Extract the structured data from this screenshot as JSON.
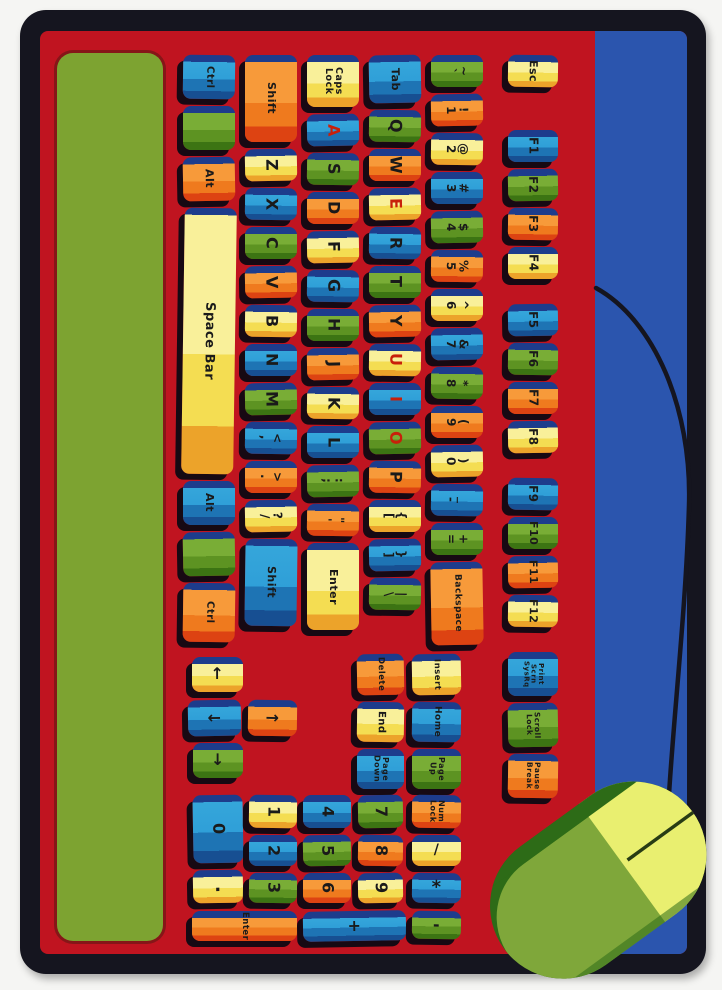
{
  "palette": {
    "border_black": "#15151f",
    "field_red": "#c01420",
    "stripe_green": "#7da331",
    "stripe_blue": "#2b55ae",
    "key_top_band_navy": "#1d3c8c",
    "key_blue": "#2f9fd8",
    "key_green": "#79ad36",
    "key_orange": "#ef7a1e",
    "key_yellow": "#f4dd52",
    "vowel_letter_red": "#c8200a",
    "mouse_dark_green": "#2d6b17",
    "mouse_light_green": "#7fa73a",
    "mouse_button_yellow": "#e9ef70",
    "cord_black": "#15151f"
  },
  "keyboard": {
    "columns": [
      {
        "x": 183,
        "w": 52,
        "y0": 55,
        "keys": [
          {
            "label": "Ctrl",
            "color": "blue",
            "u": 1.3
          },
          {
            "label": "",
            "color": "green",
            "u": 1.3
          },
          {
            "label": "Alt",
            "color": "orange",
            "u": 1.3
          },
          {
            "label": "Space Bar",
            "color": "yellow",
            "u": 7.0,
            "fs": 13
          },
          {
            "label": "Alt",
            "color": "blue",
            "u": 1.3
          },
          {
            "label": "",
            "color": "green",
            "u": 1.3
          },
          {
            "label": "Ctrl",
            "color": "orange",
            "u": 1.7
          }
        ]
      },
      {
        "x": 245,
        "w": 52,
        "y0": 55,
        "keys": [
          {
            "label": "Shift",
            "color": "orange",
            "u": 2.4,
            "fs": 11
          },
          {
            "label": "Z",
            "color": "yellow",
            "u": 1
          },
          {
            "label": "X",
            "color": "blue",
            "u": 1
          },
          {
            "label": "C",
            "color": "green",
            "u": 1
          },
          {
            "label": "V",
            "color": "orange",
            "u": 1
          },
          {
            "label": "B",
            "color": "yellow",
            "u": 1
          },
          {
            "label": "N",
            "color": "blue",
            "u": 1
          },
          {
            "label": "M",
            "color": "green",
            "u": 1
          },
          {
            "label": "<\n,",
            "color": "blue",
            "u": 1,
            "fs": 12
          },
          {
            "label": ">\n.",
            "color": "orange",
            "u": 1,
            "fs": 12
          },
          {
            "label": "?\n/",
            "color": "yellow",
            "u": 1,
            "fs": 12
          },
          {
            "label": "Shift",
            "color": "blue",
            "u": 2.4,
            "fs": 11
          }
        ]
      },
      {
        "x": 307,
        "w": 52,
        "y0": 55,
        "keys": [
          {
            "label": "Caps\nLock",
            "color": "yellow",
            "u": 1.5,
            "fs": 9.5
          },
          {
            "label": "A",
            "color": "blue",
            "u": 1,
            "red": true
          },
          {
            "label": "S",
            "color": "green",
            "u": 1
          },
          {
            "label": "D",
            "color": "orange",
            "u": 1
          },
          {
            "label": "F",
            "color": "yellow",
            "u": 1
          },
          {
            "label": "G",
            "color": "blue",
            "u": 1
          },
          {
            "label": "H",
            "color": "green",
            "u": 1
          },
          {
            "label": "J",
            "color": "orange",
            "u": 1
          },
          {
            "label": "K",
            "color": "yellow",
            "u": 1
          },
          {
            "label": "L",
            "color": "blue",
            "u": 1
          },
          {
            "label": ":\n;",
            "color": "green",
            "u": 1,
            "fs": 12
          },
          {
            "label": "\"\n'",
            "color": "orange",
            "u": 1,
            "fs": 12
          },
          {
            "label": "Enter",
            "color": "yellow",
            "u": 2.4,
            "fs": 11
          }
        ]
      },
      {
        "x": 369,
        "w": 52,
        "y0": 55,
        "keys": [
          {
            "label": "Tab",
            "color": "blue",
            "u": 1.4,
            "fs": 11
          },
          {
            "label": "Q",
            "color": "green",
            "u": 1
          },
          {
            "label": "W",
            "color": "orange",
            "u": 1
          },
          {
            "label": "E",
            "color": "yellow",
            "u": 1,
            "red": true
          },
          {
            "label": "R",
            "color": "blue",
            "u": 1
          },
          {
            "label": "T",
            "color": "green",
            "u": 1
          },
          {
            "label": "Y",
            "color": "orange",
            "u": 1
          },
          {
            "label": "U",
            "color": "yellow",
            "u": 1,
            "red": true
          },
          {
            "label": "I",
            "color": "blue",
            "u": 1,
            "red": true
          },
          {
            "label": "O",
            "color": "green",
            "u": 1,
            "red": true
          },
          {
            "label": "P",
            "color": "orange",
            "u": 1
          },
          {
            "label": "{\n[",
            "color": "yellow",
            "u": 1,
            "fs": 12
          },
          {
            "label": "}\n]",
            "color": "blue",
            "u": 1,
            "fs": 12
          },
          {
            "label": "|\n\\",
            "color": "green",
            "u": 1,
            "fs": 12
          }
        ]
      },
      {
        "x": 431,
        "w": 52,
        "y0": 55,
        "keys": [
          {
            "label": "~\n`",
            "color": "green",
            "u": 1,
            "fs": 12
          },
          {
            "label": "!\n1",
            "color": "orange",
            "u": 1,
            "fs": 12
          },
          {
            "label": "@\n2",
            "color": "yellow",
            "u": 1,
            "fs": 12
          },
          {
            "label": "#\n3",
            "color": "blue",
            "u": 1,
            "fs": 12
          },
          {
            "label": "$\n4",
            "color": "green",
            "u": 1,
            "fs": 12
          },
          {
            "label": "%\n5",
            "color": "orange",
            "u": 1,
            "fs": 12
          },
          {
            "label": "^\n6",
            "color": "yellow",
            "u": 1,
            "fs": 12
          },
          {
            "label": "&\n7",
            "color": "blue",
            "u": 1,
            "fs": 12
          },
          {
            "label": "*\n8",
            "color": "green",
            "u": 1,
            "fs": 12
          },
          {
            "label": "(\n9",
            "color": "orange",
            "u": 1,
            "fs": 12
          },
          {
            "label": ")\n0",
            "color": "yellow",
            "u": 1,
            "fs": 12
          },
          {
            "label": "_\n-",
            "color": "blue",
            "u": 1,
            "fs": 12
          },
          {
            "label": "+\n=",
            "color": "green",
            "u": 1,
            "fs": 12
          },
          {
            "label": "Backspace",
            "color": "orange",
            "u": 2.3,
            "fs": 9
          }
        ]
      },
      {
        "x": 508,
        "w": 50,
        "y0": 55,
        "keys": [
          {
            "label": "Esc",
            "color": "yellow",
            "u": 1,
            "fs": 11,
            "gapAfter": 36
          },
          {
            "label": "F1",
            "color": "blue",
            "u": 1,
            "fs": 12
          },
          {
            "label": "F2",
            "color": "green",
            "u": 1,
            "fs": 12
          },
          {
            "label": "F3",
            "color": "orange",
            "u": 1,
            "fs": 12
          },
          {
            "label": "F4",
            "color": "yellow",
            "u": 1,
            "fs": 12,
            "gapAfter": 18
          },
          {
            "label": "F5",
            "color": "blue",
            "u": 1,
            "fs": 12
          },
          {
            "label": "F6",
            "color": "green",
            "u": 1,
            "fs": 12
          },
          {
            "label": "F7",
            "color": "orange",
            "u": 1,
            "fs": 12
          },
          {
            "label": "F8",
            "color": "yellow",
            "u": 1,
            "fs": 12,
            "gapAfter": 18
          },
          {
            "label": "F9",
            "color": "blue",
            "u": 1,
            "fs": 12
          },
          {
            "label": "F10",
            "color": "green",
            "u": 1,
            "fs": 11
          },
          {
            "label": "F11",
            "color": "orange",
            "u": 1,
            "fs": 11
          },
          {
            "label": "F12",
            "color": "yellow",
            "u": 1,
            "fs": 11,
            "gapAfter": 18
          },
          {
            "label": "Print\nScrn\nSysRq",
            "color": "blue",
            "u": 1.3,
            "fs": 7
          },
          {
            "label": "Scroll\nLock",
            "color": "green",
            "u": 1.3,
            "fs": 7.5
          },
          {
            "label": "Pause\nBreak",
            "color": "orange",
            "u": 1.3,
            "fs": 7.5
          }
        ]
      }
    ],
    "arrow_keys": [
      {
        "label": "↑",
        "color": "yellow",
        "x": 192,
        "y": 657,
        "w": 51,
        "h": 35
      },
      {
        "label": "←",
        "color": "blue",
        "x": 188,
        "y": 700,
        "w": 53,
        "h": 36
      },
      {
        "label": "→",
        "color": "orange",
        "x": 248,
        "y": 700,
        "w": 49,
        "h": 36
      },
      {
        "label": "↓",
        "color": "green",
        "x": 193,
        "y": 743,
        "w": 50,
        "h": 35
      }
    ],
    "nav_keys": [
      {
        "label": "Delete",
        "color": "orange",
        "x": 357,
        "y": 654,
        "w": 47,
        "h": 41,
        "fs": 8.5
      },
      {
        "label": "End",
        "color": "yellow",
        "x": 357,
        "y": 702,
        "w": 47,
        "h": 40,
        "fs": 10
      },
      {
        "label": "Page\nDown",
        "color": "blue",
        "x": 357,
        "y": 749,
        "w": 47,
        "h": 40,
        "fs": 8
      },
      {
        "label": "Insert",
        "color": "yellow",
        "x": 412,
        "y": 654,
        "w": 49,
        "h": 41,
        "fs": 8.5
      },
      {
        "label": "Home",
        "color": "blue",
        "x": 412,
        "y": 702,
        "w": 49,
        "h": 40,
        "fs": 9
      },
      {
        "label": "Page\nUp",
        "color": "green",
        "x": 412,
        "y": 749,
        "w": 49,
        "h": 40,
        "fs": 8
      }
    ],
    "numpad_keys": [
      {
        "label": "0",
        "color": "blue",
        "x": 193,
        "y": 795,
        "w": 50,
        "h": 68
      },
      {
        "label": "1",
        "color": "yellow",
        "x": 249,
        "y": 795,
        "w": 48,
        "h": 33
      },
      {
        "label": "4",
        "color": "blue",
        "x": 303,
        "y": 795,
        "w": 48,
        "h": 33
      },
      {
        "label": "7",
        "color": "green",
        "x": 358,
        "y": 795,
        "w": 45,
        "h": 33
      },
      {
        "label": "Num\nLock",
        "color": "orange",
        "x": 412,
        "y": 795,
        "w": 49,
        "h": 33,
        "fs": 8
      },
      {
        "label": "2",
        "color": "blue",
        "x": 249,
        "y": 835,
        "w": 48,
        "h": 31
      },
      {
        "label": "5",
        "color": "green",
        "x": 303,
        "y": 835,
        "w": 48,
        "h": 31
      },
      {
        "label": "8",
        "color": "orange",
        "x": 358,
        "y": 835,
        "w": 45,
        "h": 31
      },
      {
        "label": "/",
        "color": "yellow",
        "x": 412,
        "y": 835,
        "w": 49,
        "h": 31,
        "fs": 14
      },
      {
        "label": ".",
        "color": "yellow",
        "x": 193,
        "y": 870,
        "w": 50,
        "h": 33,
        "fs": 18
      },
      {
        "label": "3",
        "color": "green",
        "x": 249,
        "y": 873,
        "w": 48,
        "h": 30
      },
      {
        "label": "6",
        "color": "orange",
        "x": 303,
        "y": 873,
        "w": 48,
        "h": 30
      },
      {
        "label": "9",
        "color": "yellow",
        "x": 358,
        "y": 873,
        "w": 45,
        "h": 30
      },
      {
        "label": "*",
        "color": "blue",
        "x": 412,
        "y": 873,
        "w": 49,
        "h": 30,
        "fs": 18
      },
      {
        "label": "Enter",
        "color": "orange",
        "x": 192,
        "y": 911,
        "w": 105,
        "h": 30,
        "fs": 8.5
      },
      {
        "label": "+",
        "color": "blue",
        "x": 303,
        "y": 911,
        "w": 103,
        "h": 30,
        "fs": 16
      },
      {
        "label": "-",
        "color": "green",
        "x": 412,
        "y": 911,
        "w": 49,
        "h": 28,
        "fs": 16
      }
    ]
  }
}
